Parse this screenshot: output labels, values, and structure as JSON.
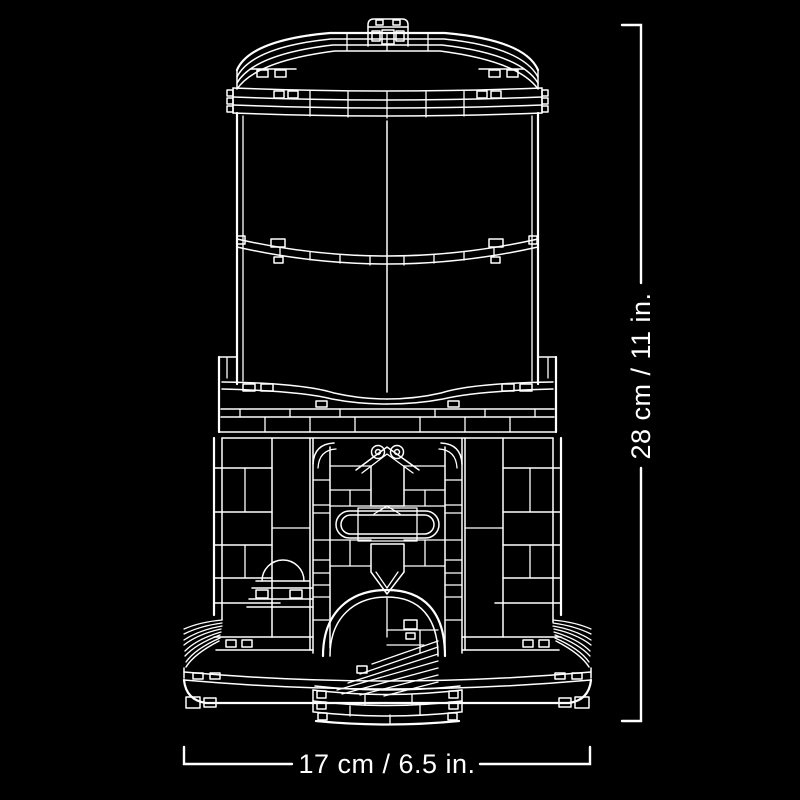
{
  "page": {
    "background_color": "#000000",
    "line_color": "#ffffff"
  },
  "diagram": {
    "type": "product-dimension-line-drawing",
    "dimensions": {
      "height": {
        "label": "28 cm / 11 in.",
        "orientation": "vertical",
        "side": "right"
      },
      "width": {
        "label": "17 cm / 6.5 in.",
        "orientation": "horizontal",
        "side": "bottom"
      }
    }
  }
}
